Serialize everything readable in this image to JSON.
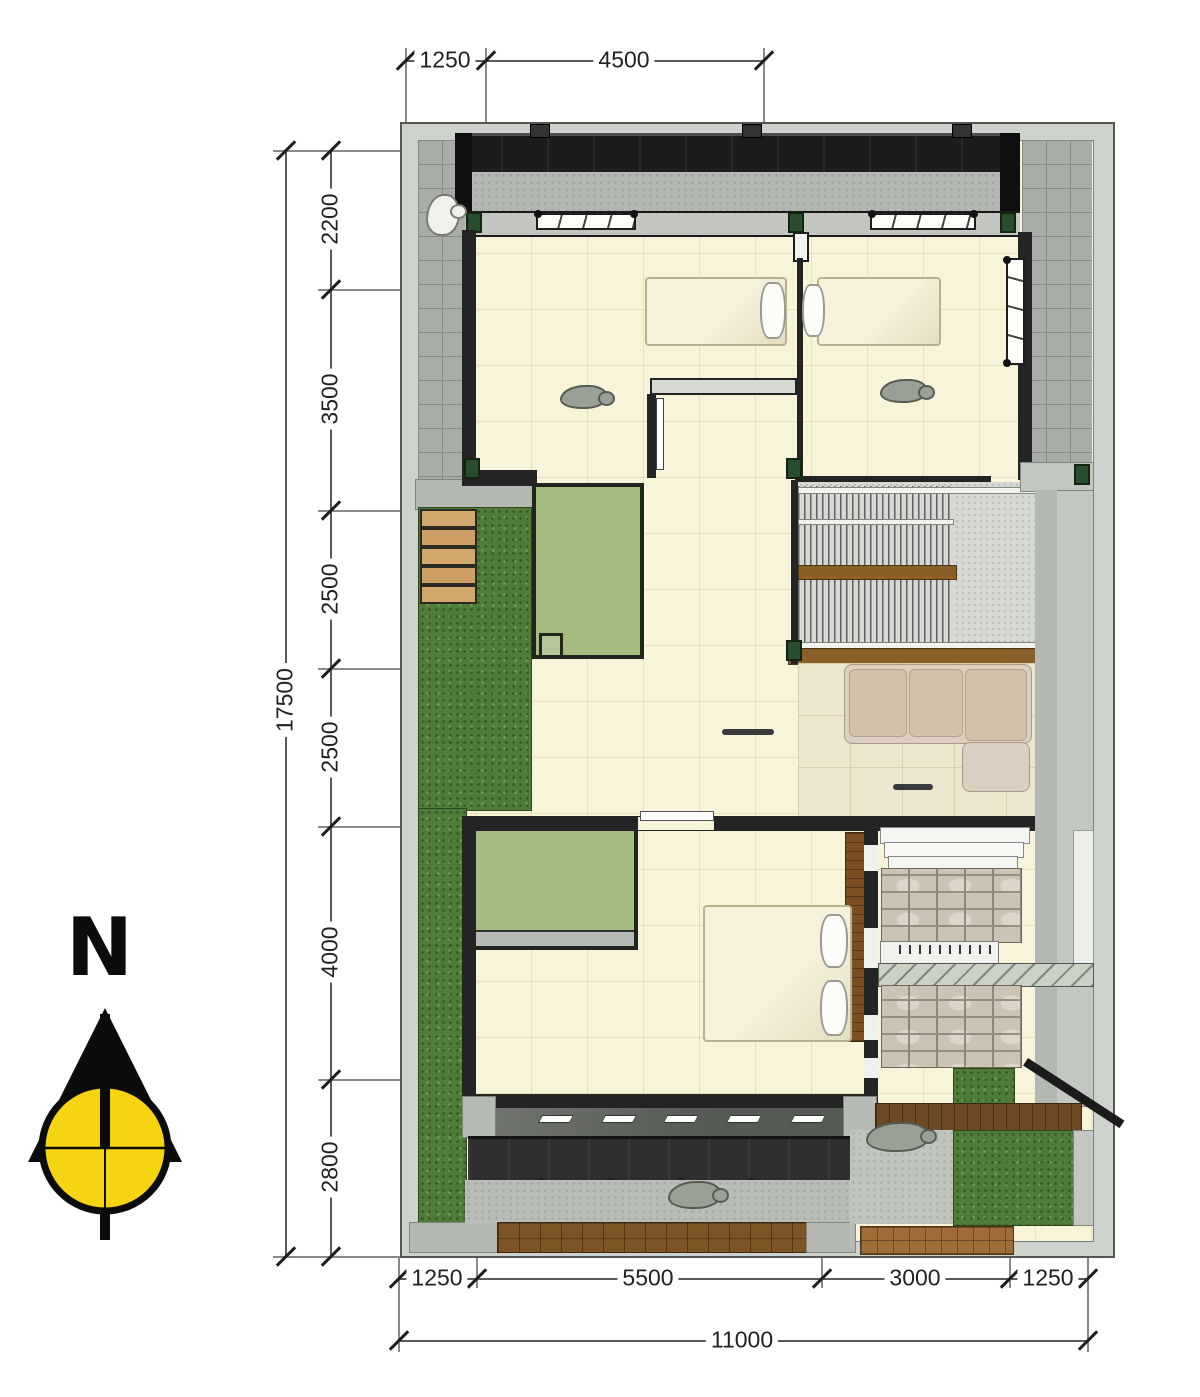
{
  "compass": {
    "label": "N"
  },
  "dimensions": {
    "top": [
      "1250",
      "4500"
    ],
    "left": [
      "2200",
      "3500",
      "2500",
      "2500",
      "4000",
      "2800"
    ],
    "left_total": "17500",
    "bottom": [
      "1250",
      "5500",
      "3000",
      "1250"
    ],
    "bottom_total": "11000"
  },
  "colors": {
    "floor_cream": "#f8f4d9",
    "living_floor": "#ebe6cd",
    "grass_green": "#4f7c38",
    "green_room": "#a4bd7e",
    "roof_dark": "#1c1c1c",
    "wood_brown": "#7b4f22",
    "tile_grey": "#a9ada7",
    "compass_yellow": "#f6d411"
  }
}
